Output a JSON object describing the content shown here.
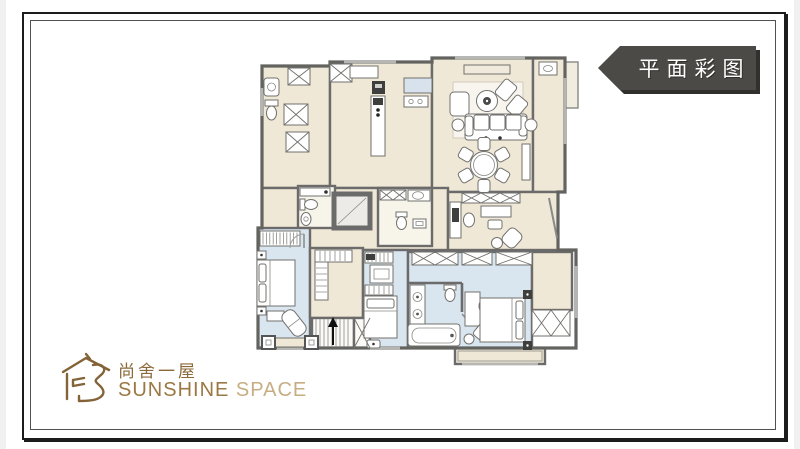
{
  "banner": {
    "label": "平面彩图",
    "bg": "#4b4a46",
    "shadow": "#31302c",
    "text_color": "#ffffff"
  },
  "logo": {
    "cn": "尚舍一屋",
    "en_first": "SUNSHINE ",
    "en_second": "SPACE",
    "gold": "#9b7843",
    "gold_light": "#c7ad82"
  },
  "palette": {
    "floor_cream": "#f0e8d6",
    "floor_blue": "#d9e5ef",
    "floor_white": "#f7f4ea",
    "wall_gray": "#6b6b6b",
    "counter_blue": "#d7e2ec",
    "frame_border": "#1c1c1c"
  }
}
